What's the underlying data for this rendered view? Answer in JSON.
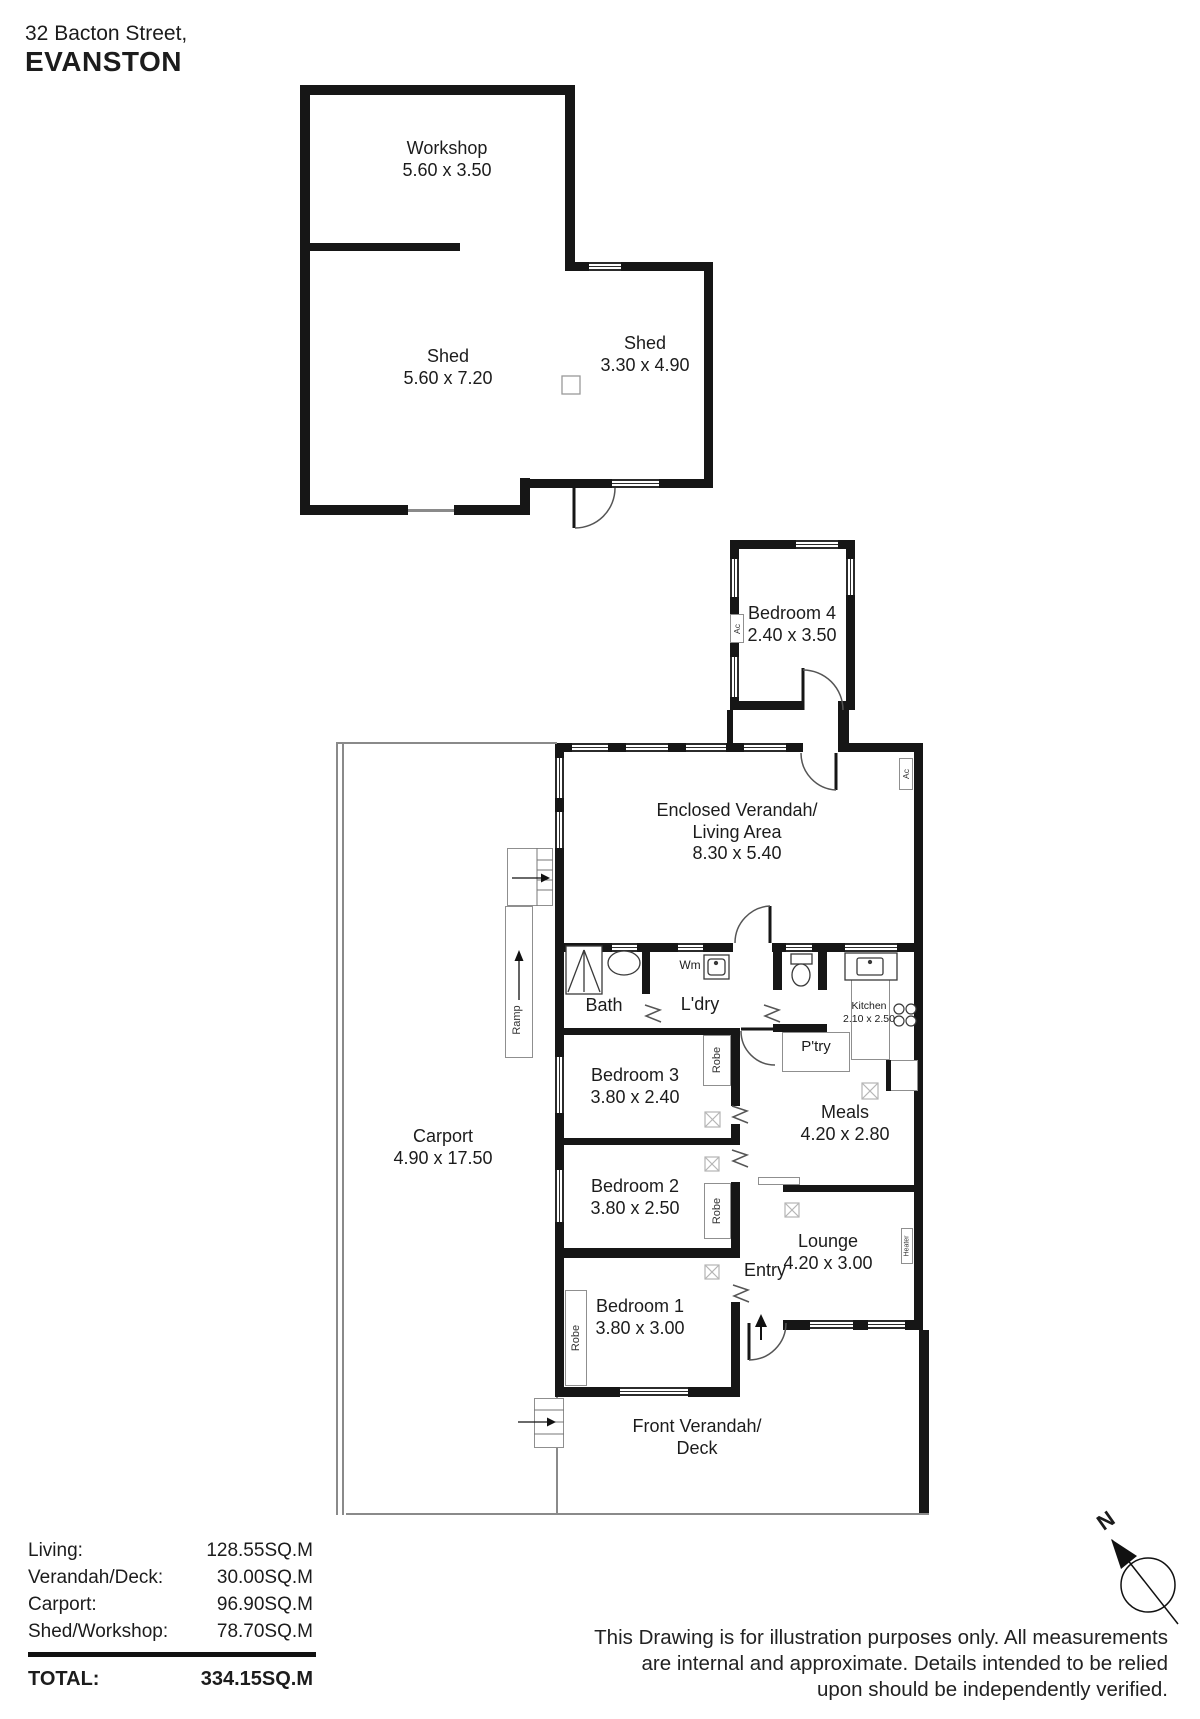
{
  "title": {
    "line1": "32 Bacton Street,",
    "line2": "EVANSTON"
  },
  "rooms": {
    "workshop": {
      "name": "Workshop",
      "dims": "5.60 x 3.50"
    },
    "shed_large": {
      "name": "Shed",
      "dims": "5.60 x 7.20"
    },
    "shed_small": {
      "name": "Shed",
      "dims": "3.30 x 4.90"
    },
    "bedroom4": {
      "name": "Bedroom 4",
      "dims": "2.40 x 3.50"
    },
    "living": {
      "line1": "Enclosed Verandah/",
      "line2": "Living Area",
      "dims": "8.30 x 5.40"
    },
    "bath": {
      "name": "Bath"
    },
    "laundry": {
      "name": "L'dry"
    },
    "pantry": {
      "name": "P'try"
    },
    "kitchen": {
      "name": "Kitchen",
      "dims": "2.10 x 2.50"
    },
    "meals": {
      "name": "Meals",
      "dims": "4.20 x 2.80"
    },
    "bedroom3": {
      "name": "Bedroom 3",
      "dims": "3.80 x 2.40"
    },
    "bedroom2": {
      "name": "Bedroom 2",
      "dims": "3.80 x 2.50"
    },
    "bedroom1": {
      "name": "Bedroom 1",
      "dims": "3.80 x 3.00"
    },
    "lounge": {
      "name": "Lounge",
      "dims": "4.20 x 3.00"
    },
    "entry": {
      "name": "Entry"
    },
    "carport": {
      "name": "Carport",
      "dims": "4.90 x 17.50"
    },
    "front_verandah": {
      "line1": "Front Verandah/",
      "line2": "Deck"
    }
  },
  "fixtures": {
    "wm": "Wm",
    "ac": "Ac",
    "robe": "Robe",
    "ramp": "Ramp",
    "heater": "Heater"
  },
  "compass": {
    "north": "N"
  },
  "summary": {
    "rows": [
      {
        "label": "Living:",
        "value": "128.55SQ.M"
      },
      {
        "label": "Verandah/Deck:",
        "value": "30.00SQ.M"
      },
      {
        "label": "Carport:",
        "value": "96.90SQ.M"
      },
      {
        "label": "Shed/Workshop:",
        "value": "78.70SQ.M"
      }
    ],
    "total_label": "TOTAL:",
    "total_value": "334.15SQ.M"
  },
  "disclaimer": {
    "line1": "This Drawing is for illustration purposes only. All measurements",
    "line2": "are internal and approximate. Details intended to be relied",
    "line3": "upon should be independently verified."
  }
}
